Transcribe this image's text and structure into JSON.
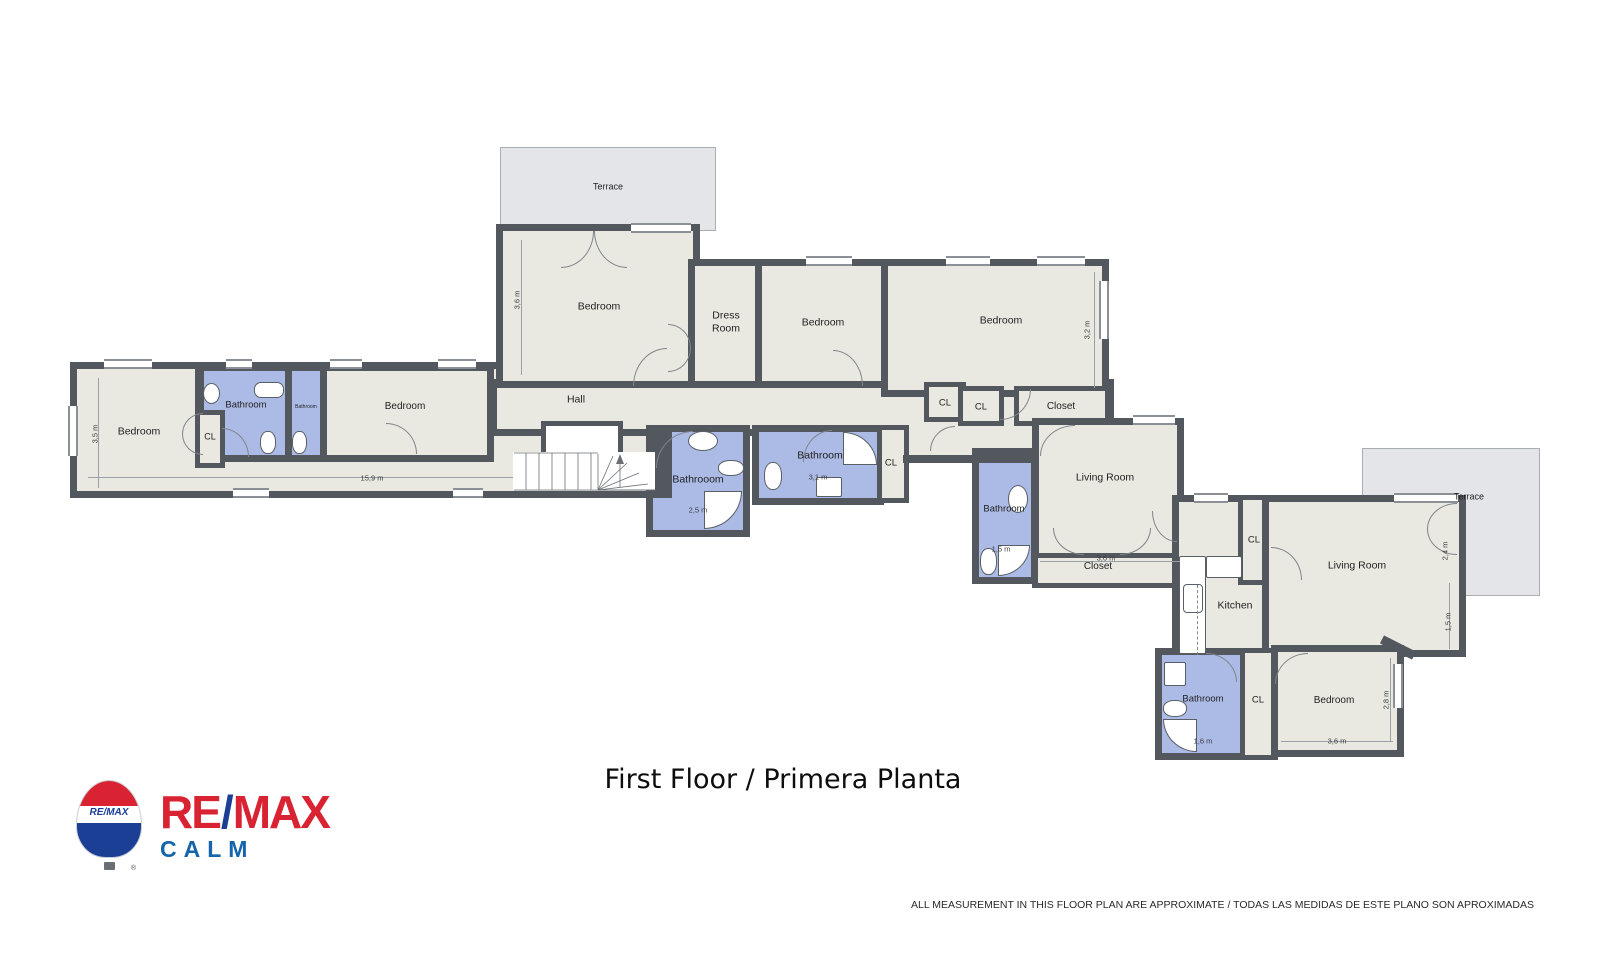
{
  "meta": {
    "title": "First Floor / Primera Planta",
    "disclaimer": "ALL MEASUREMENT IN THIS FLOOR PLAN ARE APPROXIMATE / TODAS LAS MEDIDAS DE ESTE PLANO SON APROXIMADAS"
  },
  "brand": {
    "re": "RE",
    "slash": "/",
    "max": "MAX",
    "sub": "CALM",
    "balloon_text": "RE/MAX",
    "reg": "®"
  },
  "colors": {
    "wall": "#53575e",
    "room": "#e9e9e2",
    "bath": "#acbae6",
    "terrace": "#e3e5e9",
    "terrace_border": "#a8adb2",
    "bred": "#da2332",
    "bblue": "#1b3f94",
    "calm": "#1565ad"
  },
  "plan": {
    "rooms": [
      {
        "id": "terrace-top",
        "kind": "terrace",
        "x": 500,
        "y": 147,
        "w": 216,
        "h": 84
      },
      {
        "id": "terrace-right",
        "kind": "terrace",
        "x": 1362,
        "y": 448,
        "w": 178,
        "h": 148
      },
      {
        "id": "left-wing",
        "kind": "room",
        "x": 70,
        "y": 362,
        "w": 600,
        "h": 136
      },
      {
        "id": "hall",
        "kind": "room",
        "x": 490,
        "y": 379,
        "w": 624,
        "h": 57
      },
      {
        "id": "hall-ext",
        "kind": "patch",
        "x": 884,
        "y": 418,
        "w": 150,
        "h": 44
      },
      {
        "id": "bedroom-1",
        "kind": "room",
        "x": 496,
        "y": 224,
        "w": 204,
        "h": 164
      },
      {
        "id": "dress-room",
        "kind": "room",
        "x": 688,
        "y": 259,
        "w": 74,
        "h": 129
      },
      {
        "id": "bedroom-2",
        "kind": "room",
        "x": 755,
        "y": 259,
        "w": 138,
        "h": 129
      },
      {
        "id": "bedroom-3",
        "kind": "room",
        "x": 881,
        "y": 259,
        "w": 228,
        "h": 138
      },
      {
        "id": "cl-a",
        "kind": "closet",
        "x": 924,
        "y": 382,
        "w": 42,
        "h": 40
      },
      {
        "id": "cl-b",
        "kind": "closet",
        "x": 958,
        "y": 386,
        "w": 46,
        "h": 40
      },
      {
        "id": "closet-top",
        "kind": "closet",
        "x": 1014,
        "y": 386,
        "w": 96,
        "h": 40
      },
      {
        "id": "living-room-1",
        "kind": "room",
        "x": 1032,
        "y": 418,
        "w": 152,
        "h": 144
      },
      {
        "id": "closet-strip",
        "kind": "closet",
        "x": 1032,
        "y": 553,
        "w": 152,
        "h": 35
      },
      {
        "id": "bathroom-3",
        "kind": "bath",
        "x": 972,
        "y": 448,
        "w": 66,
        "h": 136
      },
      {
        "id": "kitchen",
        "kind": "room",
        "x": 1172,
        "y": 495,
        "w": 136,
        "h": 168
      },
      {
        "id": "cl-kitchen",
        "kind": "closet",
        "x": 1238,
        "y": 495,
        "w": 34,
        "h": 90
      },
      {
        "id": "living-room-2",
        "kind": "room",
        "x": 1262,
        "y": 495,
        "w": 204,
        "h": 162
      },
      {
        "id": "bathroom-4",
        "kind": "bath",
        "x": 1155,
        "y": 648,
        "w": 92,
        "h": 112
      },
      {
        "id": "cl-bottom",
        "kind": "closet",
        "x": 1240,
        "y": 648,
        "w": 38,
        "h": 112
      },
      {
        "id": "bedroom-4",
        "kind": "room",
        "x": 1271,
        "y": 645,
        "w": 133,
        "h": 112
      },
      {
        "id": "bathroom-c1",
        "kind": "bath",
        "x": 646,
        "y": 425,
        "w": 104,
        "h": 112
      },
      {
        "id": "bathroom-c2",
        "kind": "bath",
        "x": 752,
        "y": 425,
        "w": 132,
        "h": 80
      },
      {
        "id": "cl-mid",
        "kind": "closet",
        "x": 877,
        "y": 425,
        "w": 32,
        "h": 78
      },
      {
        "id": "bathroom-l1",
        "kind": "bath",
        "x": 197,
        "y": 364,
        "w": 95,
        "h": 98
      },
      {
        "id": "bathroom-l2",
        "kind": "bath",
        "x": 285,
        "y": 364,
        "w": 42,
        "h": 98
      },
      {
        "id": "bedroom-mid",
        "kind": "room",
        "x": 320,
        "y": 364,
        "w": 174,
        "h": 98
      },
      {
        "id": "cl-left",
        "kind": "closet",
        "x": 195,
        "y": 410,
        "w": 30,
        "h": 58
      },
      {
        "id": "stair-void",
        "kind": "void",
        "x": 541,
        "y": 421,
        "w": 82,
        "h": 36
      }
    ],
    "walls": [
      {
        "x": 195,
        "y": 369,
        "w": 9,
        "h": 46
      },
      {
        "x": 903,
        "y": 455,
        "w": 134,
        "h": 8
      },
      {
        "x": 650,
        "y": 430,
        "w": 22,
        "h": 68
      },
      {
        "x": 1380,
        "y": 643,
        "w": 36,
        "h": 9,
        "rot": 27
      }
    ],
    "windows": [
      {
        "x": 631,
        "y": 223,
        "w": 60,
        "h": 10
      },
      {
        "x": 806,
        "y": 256,
        "w": 46,
        "h": 10
      },
      {
        "x": 946,
        "y": 256,
        "w": 44,
        "h": 10
      },
      {
        "x": 1037,
        "y": 256,
        "w": 48,
        "h": 10
      },
      {
        "x": 1099,
        "y": 281,
        "w": 10,
        "h": 58
      },
      {
        "x": 104,
        "y": 359,
        "w": 48,
        "h": 10
      },
      {
        "x": 226,
        "y": 359,
        "w": 26,
        "h": 10
      },
      {
        "x": 330,
        "y": 359,
        "w": 32,
        "h": 10
      },
      {
        "x": 438,
        "y": 359,
        "w": 38,
        "h": 10
      },
      {
        "x": 68,
        "y": 406,
        "w": 10,
        "h": 50
      },
      {
        "x": 233,
        "y": 488,
        "w": 36,
        "h": 10
      },
      {
        "x": 453,
        "y": 488,
        "w": 30,
        "h": 10
      },
      {
        "x": 1133,
        "y": 415,
        "w": 42,
        "h": 10
      },
      {
        "x": 1194,
        "y": 493,
        "w": 34,
        "h": 10
      },
      {
        "x": 1394,
        "y": 493,
        "w": 64,
        "h": 10
      },
      {
        "x": 1393,
        "y": 664,
        "w": 10,
        "h": 44
      }
    ],
    "doors": [
      {
        "x": 561,
        "y": 231,
        "w": 33,
        "h": 37,
        "c": "br"
      },
      {
        "x": 594,
        "y": 231,
        "w": 33,
        "h": 37,
        "c": "bl"
      },
      {
        "x": 633,
        "y": 348,
        "w": 34,
        "h": 38,
        "c": "tl"
      },
      {
        "x": 668,
        "y": 324,
        "w": 23,
        "h": 24,
        "c": "tr"
      },
      {
        "x": 668,
        "y": 348,
        "w": 23,
        "h": 24,
        "c": "br"
      },
      {
        "x": 833,
        "y": 350,
        "w": 30,
        "h": 36,
        "c": "tr"
      },
      {
        "x": 1000,
        "y": 389,
        "w": 31,
        "h": 31,
        "c": "br"
      },
      {
        "x": 1040,
        "y": 425,
        "w": 35,
        "h": 31,
        "c": "tl"
      },
      {
        "x": 1053,
        "y": 528,
        "w": 31,
        "h": 27,
        "c": "bl"
      },
      {
        "x": 1120,
        "y": 528,
        "w": 31,
        "h": 27,
        "c": "br"
      },
      {
        "x": 803,
        "y": 430,
        "w": 29,
        "h": 32,
        "c": "tl"
      },
      {
        "x": 656,
        "y": 431,
        "w": 37,
        "h": 37,
        "c": "tl"
      },
      {
        "x": 1427,
        "y": 503,
        "w": 30,
        "h": 26,
        "c": "tl"
      },
      {
        "x": 1427,
        "y": 529,
        "w": 30,
        "h": 26,
        "c": "bl"
      },
      {
        "x": 1271,
        "y": 547,
        "w": 31,
        "h": 33,
        "c": "tr"
      },
      {
        "x": 1152,
        "y": 511,
        "w": 25,
        "h": 31,
        "c": "bl"
      },
      {
        "x": 1275,
        "y": 653,
        "w": 33,
        "h": 31,
        "c": "tl"
      },
      {
        "x": 1206,
        "y": 653,
        "w": 31,
        "h": 29,
        "c": "tr"
      },
      {
        "x": 182,
        "y": 413,
        "w": 21,
        "h": 21,
        "c": "tl"
      },
      {
        "x": 182,
        "y": 434,
        "w": 21,
        "h": 21,
        "c": "bl"
      },
      {
        "x": 386,
        "y": 423,
        "w": 31,
        "h": 31,
        "c": "tr"
      },
      {
        "x": 222,
        "y": 428,
        "w": 27,
        "h": 29,
        "c": "tr"
      },
      {
        "x": 930,
        "y": 426,
        "w": 25,
        "h": 25,
        "c": "tl"
      }
    ],
    "fixtures": [
      {
        "t": "sink",
        "x": 203,
        "y": 383,
        "w": 17,
        "h": 21
      },
      {
        "t": "sink",
        "x": 688,
        "y": 431,
        "w": 30,
        "h": 20
      },
      {
        "t": "sink",
        "x": 1008,
        "y": 485,
        "w": 20,
        "h": 28
      },
      {
        "t": "tub",
        "x": 254,
        "y": 382,
        "w": 30,
        "h": 16
      },
      {
        "t": "toilet",
        "x": 260,
        "y": 431,
        "w": 16,
        "h": 23
      },
      {
        "t": "toilet",
        "x": 292,
        "y": 431,
        "w": 15,
        "h": 23
      },
      {
        "t": "toilet",
        "x": 718,
        "y": 460,
        "w": 26,
        "h": 16
      },
      {
        "t": "toilet",
        "x": 764,
        "y": 462,
        "w": 18,
        "h": 28
      },
      {
        "t": "toilet",
        "x": 980,
        "y": 548,
        "w": 17,
        "h": 27
      },
      {
        "t": "toilet",
        "x": 1163,
        "y": 700,
        "w": 24,
        "h": 17
      },
      {
        "t": "box",
        "x": 816,
        "y": 477,
        "w": 26,
        "h": 20
      },
      {
        "t": "box",
        "x": 1164,
        "y": 662,
        "w": 22,
        "h": 24
      },
      {
        "t": "box",
        "x": 1206,
        "y": 556,
        "w": 36,
        "h": 22
      },
      {
        "t": "shower",
        "x": 704,
        "y": 491,
        "w": 38,
        "h": 38,
        "c": "br"
      },
      {
        "t": "shower",
        "x": 843,
        "y": 432,
        "w": 34,
        "h": 33,
        "c": "tr"
      },
      {
        "t": "shower",
        "x": 998,
        "y": 545,
        "w": 32,
        "h": 31,
        "c": "br"
      },
      {
        "t": "shower",
        "x": 1163,
        "y": 719,
        "w": 34,
        "h": 33,
        "c": "bl"
      },
      {
        "t": "counter",
        "x": 1179,
        "y": 556,
        "w": 27,
        "h": 98
      },
      {
        "t": "fridge",
        "x": 1183,
        "y": 584,
        "w": 20,
        "h": 29
      },
      {
        "t": "dashed",
        "x": 1197,
        "y": 585,
        "w": 1,
        "h": 70
      }
    ],
    "stairs": {
      "x": 512,
      "y": 446,
      "w": 150,
      "h": 46
    },
    "labels": [
      {
        "text": "Terrace",
        "x": 608,
        "y": 187,
        "fs": 9
      },
      {
        "text": "Bedroom",
        "x": 599,
        "y": 307,
        "fs": 10.5
      },
      {
        "text": "Dress\nRoom",
        "x": 726,
        "y": 322,
        "fs": 10.5
      },
      {
        "text": "Bedroom",
        "x": 823,
        "y": 323,
        "fs": 10.5
      },
      {
        "text": "Bedroom",
        "x": 1001,
        "y": 321,
        "fs": 10.5
      },
      {
        "text": "Hall",
        "x": 576,
        "y": 400,
        "fs": 10.5
      },
      {
        "text": "Bedroom",
        "x": 139,
        "y": 432,
        "fs": 10.5
      },
      {
        "text": "CL",
        "x": 210,
        "y": 437,
        "fs": 9
      },
      {
        "text": "Bathroom",
        "x": 246,
        "y": 405,
        "fs": 9.5
      },
      {
        "text": "Bathroom",
        "x": 306,
        "y": 407,
        "fs": 5
      },
      {
        "text": "Bedroom",
        "x": 405,
        "y": 407,
        "fs": 10
      },
      {
        "text": "Bathrooom",
        "x": 698,
        "y": 480,
        "fs": 10.5
      },
      {
        "text": "Bathroom",
        "x": 820,
        "y": 456,
        "fs": 10.5
      },
      {
        "text": "CL",
        "x": 891,
        "y": 463,
        "fs": 9.5
      },
      {
        "text": "CL",
        "x": 945,
        "y": 403,
        "fs": 9.5
      },
      {
        "text": "CL",
        "x": 981,
        "y": 407,
        "fs": 9.5
      },
      {
        "text": "Closet",
        "x": 1061,
        "y": 407,
        "fs": 10
      },
      {
        "text": "Living Room",
        "x": 1105,
        "y": 478,
        "fs": 10.5
      },
      {
        "text": "Bathroom",
        "x": 1004,
        "y": 509,
        "fs": 9.5
      },
      {
        "text": "Closet",
        "x": 1098,
        "y": 567,
        "fs": 10
      },
      {
        "text": "Kitchen",
        "x": 1235,
        "y": 606,
        "fs": 10.5
      },
      {
        "text": "CL",
        "x": 1254,
        "y": 540,
        "fs": 9.5
      },
      {
        "text": "Living Room",
        "x": 1357,
        "y": 566,
        "fs": 10.5
      },
      {
        "text": "Terrace",
        "x": 1469,
        "y": 497,
        "fs": 9
      },
      {
        "text": "Bathroom",
        "x": 1203,
        "y": 699,
        "fs": 9.5
      },
      {
        "text": "CL",
        "x": 1258,
        "y": 700,
        "fs": 9.5
      },
      {
        "text": "Bedroom",
        "x": 1334,
        "y": 701,
        "fs": 10
      }
    ],
    "dims": [
      {
        "text": "3,6 m",
        "x": 517,
        "y": 300,
        "v": true
      },
      {
        "text": "3,2 m",
        "x": 1087,
        "y": 330,
        "v": true
      },
      {
        "text": "3,5 m",
        "x": 95,
        "y": 434,
        "v": true
      },
      {
        "text": "15,9 m",
        "x": 372,
        "y": 478
      },
      {
        "text": "2,5 m",
        "x": 698,
        "y": 510
      },
      {
        "text": "3,1 m",
        "x": 818,
        "y": 477
      },
      {
        "text": "1,5 m",
        "x": 1001,
        "y": 549
      },
      {
        "text": "3,6 m",
        "x": 1106,
        "y": 558
      },
      {
        "text": "2,4 m",
        "x": 1445,
        "y": 551,
        "v": true
      },
      {
        "text": "1,5 m",
        "x": 1448,
        "y": 622,
        "v": true
      },
      {
        "text": "1,6 m",
        "x": 1203,
        "y": 741
      },
      {
        "text": "3,6 m",
        "x": 1337,
        "y": 741
      },
      {
        "text": "2,8 m",
        "x": 1386,
        "y": 700,
        "v": true
      }
    ],
    "dimlines": [
      {
        "x": 521,
        "y": 240,
        "w": 1,
        "h": 135
      },
      {
        "x": 1094,
        "y": 272,
        "w": 1,
        "h": 116
      },
      {
        "x": 98,
        "y": 378,
        "w": 1,
        "h": 110
      },
      {
        "x": 88,
        "y": 477,
        "w": 556,
        "h": 1
      },
      {
        "x": 1040,
        "y": 561,
        "w": 140,
        "h": 1
      },
      {
        "x": 1281,
        "y": 741,
        "w": 112,
        "h": 1
      },
      {
        "x": 1390,
        "y": 658,
        "w": 1,
        "h": 84
      },
      {
        "x": 1449,
        "y": 583,
        "w": 1,
        "h": 66
      }
    ]
  }
}
